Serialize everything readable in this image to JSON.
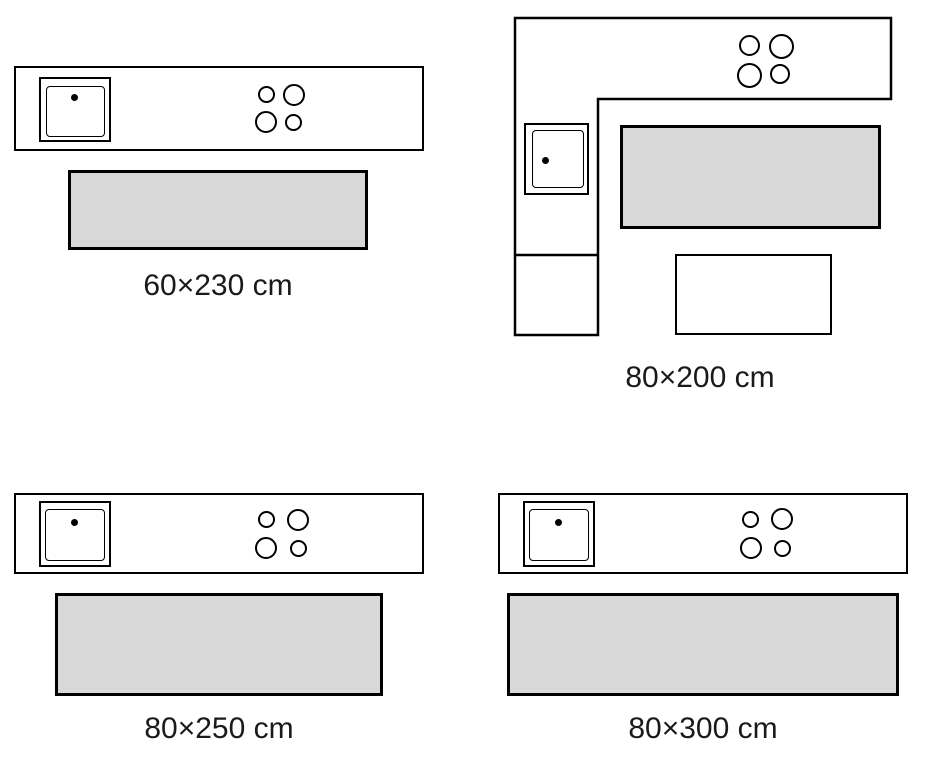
{
  "colors": {
    "background": "#ffffff",
    "outline": "#000000",
    "rug_fill": "#d8d8d8",
    "label_text": "#1a1a1a"
  },
  "icons": {
    "sink": "double-square-with-faucet-dot",
    "burner": "outlined-circle"
  },
  "diagrams": [
    {
      "kitchen_layout": "straight-counter",
      "rug_size_label": "60×230 cm"
    },
    {
      "kitchen_layout": "l-shaped-counter",
      "rug_size_label": "80×200 cm"
    },
    {
      "kitchen_layout": "straight-counter",
      "rug_size_label": "80×250 cm"
    },
    {
      "kitchen_layout": "straight-counter",
      "rug_size_label": "80×300 cm"
    }
  ]
}
